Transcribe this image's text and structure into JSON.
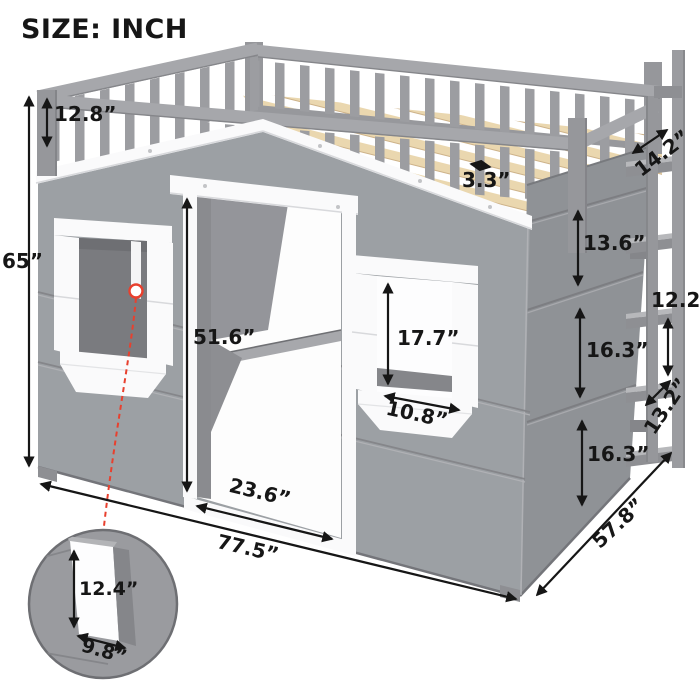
{
  "title": "SIZE: INCH",
  "unit": "INCH",
  "colors": {
    "accent_red": "#e8402e",
    "wall_gray": "#9ca0a4",
    "side_wall_gray": "#8f9296",
    "trim_white": "#fafafb",
    "wood_tan": "#ead7af",
    "text_ink": "#161616"
  },
  "dimensions": {
    "rail_height": "12.8”",
    "total_height": "65”",
    "slat_spacing": "3.3”",
    "ladder_depth": "14.2”",
    "side_panel_top": "13.6”",
    "rung_spacing": "12.2”",
    "side_panel_middle": "16.3”",
    "ladder_step": "13.2”",
    "side_panel_bottom": "16.3”",
    "door_height": "51.6”",
    "window_height": "17.7”",
    "window_width": "10.8”",
    "door_width": "23.6”",
    "overall_width": "77.5”",
    "overall_depth": "57.8”"
  },
  "callout": {
    "opening_height": "12.4”",
    "opening_width": "9.8”"
  }
}
